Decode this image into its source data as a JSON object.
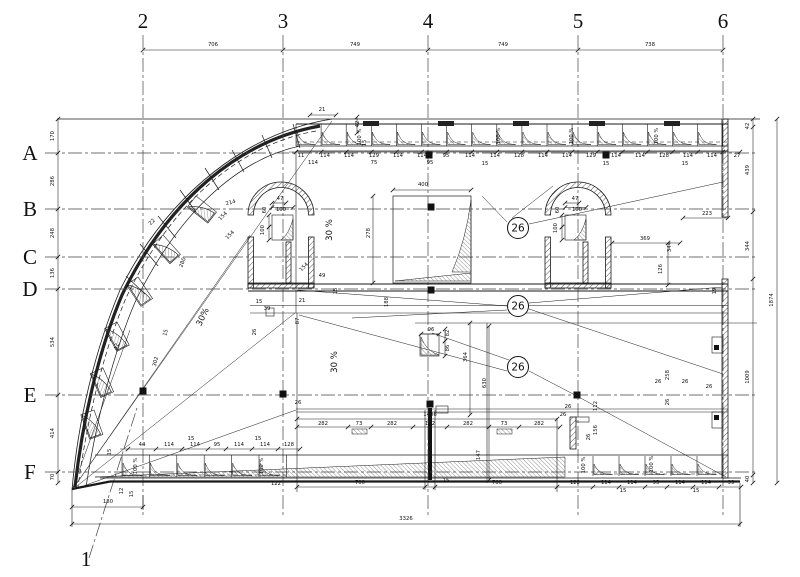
{
  "drawing": {
    "axes": {
      "cols": [
        {
          "label": "2",
          "x": 143
        },
        {
          "label": "3",
          "x": 283
        },
        {
          "label": "4",
          "x": 428
        },
        {
          "label": "5",
          "x": 578
        },
        {
          "label": "6",
          "x": 723
        }
      ],
      "col1": {
        "label": "1",
        "x": 86,
        "y": 566
      },
      "rows": [
        {
          "label": "A",
          "y": 153
        },
        {
          "label": "B",
          "y": 209
        },
        {
          "label": "C",
          "y": 257
        },
        {
          "label": "D",
          "y": 289
        },
        {
          "label": "E",
          "y": 395
        },
        {
          "label": "F",
          "y": 472
        }
      ]
    },
    "callouts": [
      {
        "text": "26",
        "x": 518,
        "y": 228
      },
      {
        "text": "26",
        "x": 518,
        "y": 306
      },
      {
        "text": "26",
        "x": 518,
        "y": 367
      }
    ],
    "notes": [
      [
        "30%",
        205,
        318,
        -65
      ],
      [
        "30 %",
        332,
        230,
        -90
      ],
      [
        "30 %",
        337,
        362,
        -90
      ]
    ],
    "dims": [
      [
        "706",
        213,
        46,
        0
      ],
      [
        "749",
        355,
        46,
        0
      ],
      [
        "749",
        503,
        46,
        0
      ],
      [
        "738",
        650,
        46,
        0
      ],
      [
        "170",
        54,
        136,
        -90
      ],
      [
        "286",
        54,
        181,
        -90
      ],
      [
        "248",
        54,
        233,
        -90
      ],
      [
        "136",
        54,
        273,
        -90
      ],
      [
        "534",
        54,
        342,
        -90
      ],
      [
        "414",
        54,
        433,
        -90
      ],
      [
        "70",
        54,
        477,
        -90
      ],
      [
        "42",
        749,
        126,
        -90
      ],
      [
        "439",
        749,
        170,
        -90
      ],
      [
        "344",
        749,
        246,
        -90
      ],
      [
        "1009",
        749,
        377,
        -90
      ],
      [
        "40",
        749,
        479,
        -90
      ],
      [
        "1874",
        773,
        300,
        -90
      ],
      [
        "180",
        108,
        503,
        0
      ],
      [
        "3326",
        406,
        520,
        0
      ],
      [
        "122",
        276,
        485,
        0
      ],
      [
        "700",
        360,
        484,
        0
      ],
      [
        "15",
        446,
        482,
        0
      ],
      [
        "700",
        497,
        484,
        0
      ],
      [
        "122",
        575,
        484,
        0
      ],
      [
        "114",
        606,
        484,
        0
      ],
      [
        "114",
        632,
        484,
        0
      ],
      [
        "95",
        656,
        484,
        0
      ],
      [
        "114",
        680,
        484,
        0
      ],
      [
        "114",
        706,
        484,
        0
      ],
      [
        "99",
        731,
        484,
        0
      ],
      [
        "15",
        623,
        492,
        0
      ],
      [
        "15",
        696,
        492,
        0
      ],
      [
        "44",
        142,
        446,
        0
      ],
      [
        "114",
        169,
        446,
        0
      ],
      [
        "114",
        195,
        446,
        0
      ],
      [
        "95",
        217,
        446,
        0
      ],
      [
        "114",
        239,
        446,
        0
      ],
      [
        "114",
        265,
        446,
        0
      ],
      [
        "128",
        289,
        446,
        0
      ],
      [
        "15",
        191,
        440,
        0
      ],
      [
        "15",
        258,
        440,
        0
      ],
      [
        "12",
        123,
        491,
        -90
      ],
      [
        "15",
        133,
        494,
        -90
      ],
      [
        "15",
        111,
        452,
        -90
      ],
      [
        "100 %",
        137,
        466,
        -90
      ],
      [
        "100 %",
        263,
        466,
        -90
      ],
      [
        "100 %",
        585,
        465,
        -90
      ],
      [
        "100 %",
        653,
        464,
        -90
      ],
      [
        "11",
        301,
        157,
        0
      ],
      [
        "114",
        325,
        157,
        0
      ],
      [
        "114",
        349,
        157,
        0
      ],
      [
        "129",
        374,
        157,
        0
      ],
      [
        "114",
        398,
        157,
        0
      ],
      [
        "114",
        422,
        157,
        0
      ],
      [
        "95",
        446,
        157,
        0
      ],
      [
        "114",
        470,
        157,
        0
      ],
      [
        "114",
        495,
        157,
        0
      ],
      [
        "128",
        519,
        157,
        0
      ],
      [
        "114",
        543,
        157,
        0
      ],
      [
        "114",
        567,
        157,
        0
      ],
      [
        "129",
        591,
        157,
        0
      ],
      [
        "114",
        616,
        157,
        0
      ],
      [
        "114",
        640,
        157,
        0
      ],
      [
        "128",
        664,
        157,
        0
      ],
      [
        "114",
        688,
        157,
        0
      ],
      [
        "114",
        712,
        157,
        0
      ],
      [
        "27",
        737,
        157,
        0
      ],
      [
        "114",
        313,
        164,
        0
      ],
      [
        "75",
        374,
        164,
        0
      ],
      [
        "95",
        430,
        164,
        0
      ],
      [
        "15",
        485,
        165,
        0
      ],
      [
        "15",
        606,
        165,
        0
      ],
      [
        "15",
        685,
        165,
        0
      ],
      [
        "100 %",
        361,
        137,
        -90
      ],
      [
        "100 %",
        500,
        136,
        -90
      ],
      [
        "100 %",
        573,
        136,
        -90
      ],
      [
        "100 %",
        658,
        136,
        -90
      ],
      [
        "21",
        322,
        111,
        0
      ],
      [
        "42",
        359,
        124,
        -90
      ],
      [
        "15",
        366,
        143,
        -90
      ],
      [
        "47",
        280,
        200,
        0
      ],
      [
        "100",
        281,
        211,
        0
      ],
      [
        "60",
        266,
        210,
        -90
      ],
      [
        "100",
        264,
        230,
        -90
      ],
      [
        "47",
        575,
        200,
        0
      ],
      [
        "100",
        577,
        211,
        0
      ],
      [
        "60",
        559,
        210,
        -90
      ],
      [
        "100",
        557,
        228,
        -90
      ],
      [
        "22",
        153,
        223,
        -45
      ],
      [
        "214",
        231,
        204,
        -15
      ],
      [
        "154",
        224,
        217,
        -45
      ],
      [
        "154",
        231,
        236,
        -45
      ],
      [
        "280",
        184,
        263,
        -70
      ],
      [
        "302",
        157,
        362,
        -75
      ],
      [
        "42",
        118,
        347,
        -75
      ],
      [
        "15",
        167,
        333,
        -75
      ],
      [
        "49",
        322,
        277,
        0
      ],
      [
        "154",
        305,
        268,
        -45
      ],
      [
        "21",
        302,
        302,
        0
      ],
      [
        "87",
        299,
        321,
        -90
      ],
      [
        "15",
        337,
        291,
        -90
      ],
      [
        "39",
        267,
        310,
        0
      ],
      [
        "15",
        259,
        303,
        0
      ],
      [
        "26",
        256,
        332,
        -90
      ],
      [
        "400",
        423,
        186,
        0
      ],
      [
        "278",
        370,
        233,
        -90
      ],
      [
        "188",
        388,
        302,
        -90
      ],
      [
        "364",
        467,
        357,
        -90
      ],
      [
        "630",
        486,
        383,
        -90
      ],
      [
        "96",
        431,
        331,
        0
      ],
      [
        "82",
        449,
        333,
        -90
      ],
      [
        "86",
        449,
        348,
        -90
      ],
      [
        "369",
        645,
        240,
        0
      ],
      [
        "344",
        671,
        247,
        -90
      ],
      [
        "126",
        662,
        269,
        -90
      ],
      [
        "223",
        707,
        215,
        0
      ],
      [
        "19",
        716,
        291,
        -90
      ],
      [
        "26",
        298,
        404,
        0
      ],
      [
        "1406",
        430,
        416,
        0
      ],
      [
        "282",
        323,
        425,
        0
      ],
      [
        "73",
        359,
        425,
        0
      ],
      [
        "282",
        392,
        425,
        0
      ],
      [
        "102",
        430,
        425,
        0
      ],
      [
        "282",
        468,
        425,
        0
      ],
      [
        "73",
        504,
        425,
        0
      ],
      [
        "282",
        539,
        425,
        0
      ],
      [
        "147",
        480,
        455,
        -90
      ],
      [
        "26",
        568,
        408,
        0
      ],
      [
        "26",
        563,
        416,
        0
      ],
      [
        "112",
        597,
        406,
        -90
      ],
      [
        "156",
        597,
        430,
        -90
      ],
      [
        "26",
        590,
        437,
        -90
      ],
      [
        "258",
        669,
        375,
        -90
      ],
      [
        "26",
        658,
        383,
        0
      ],
      [
        "26",
        685,
        383,
        0
      ],
      [
        "26",
        709,
        388,
        0
      ],
      [
        "26",
        669,
        402,
        -90
      ]
    ]
  }
}
